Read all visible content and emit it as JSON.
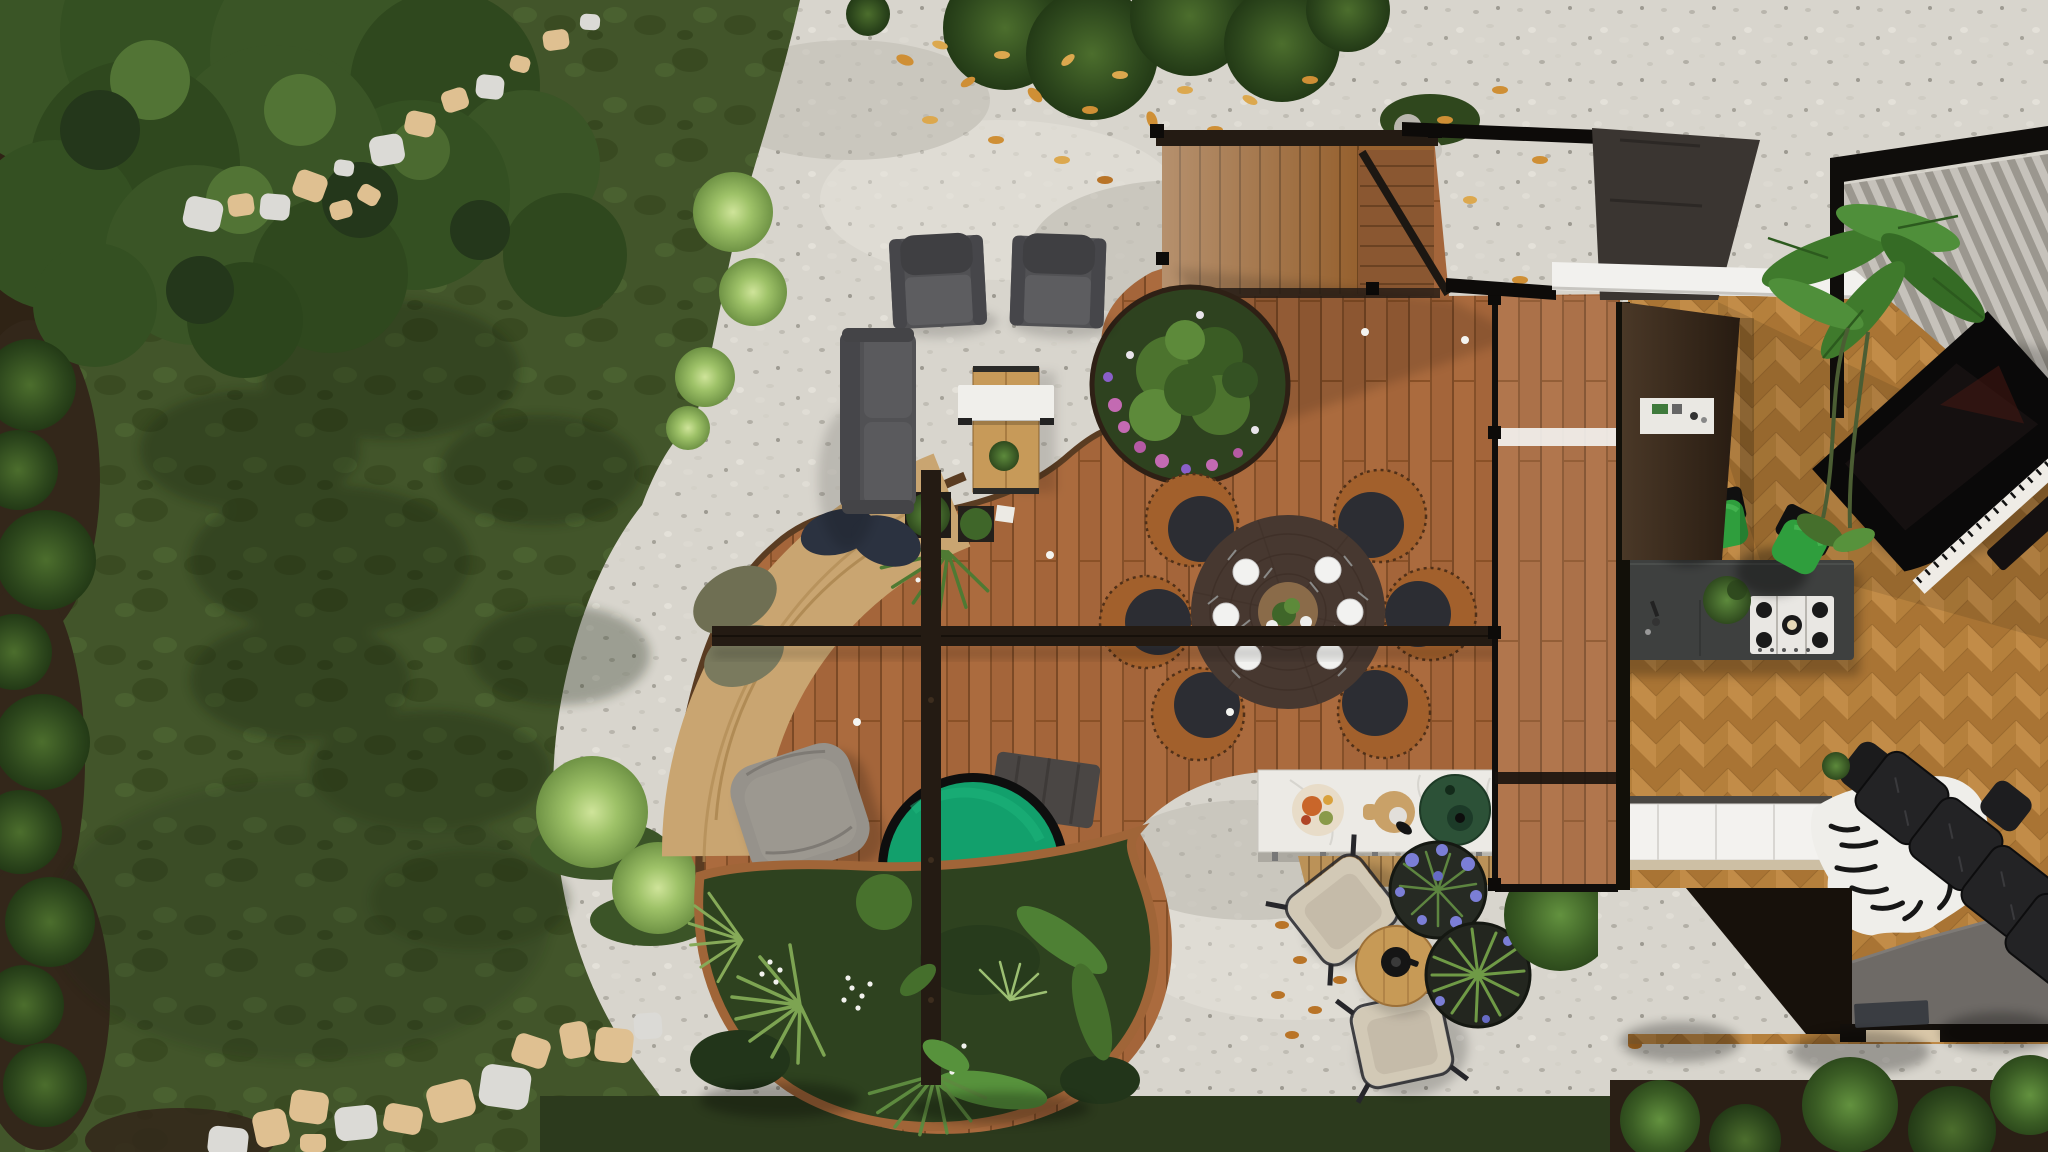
{
  "canvas": {
    "width": 2048,
    "height": 1152
  },
  "scene": {
    "type": "top-down landscape and interior design render",
    "areas": {
      "backyard_lawn": {
        "features": [
          "tree canopy",
          "upper stepping-stone path",
          "lower stepping-stone path",
          "shrub border",
          "ornamental grass puffs"
        ]
      },
      "gravel_patio": {
        "furniture": [
          "lounge armchair x2",
          "outdoor sofa",
          "wood table with white bench",
          "butterfly lounge chair x2",
          "round side table with kettle",
          "agapanthus planter pots"
        ]
      },
      "curved_deck": {
        "features": [
          "staircase",
          "round flower planter",
          "round dining table with six rattan chairs",
          "pergola beam and post",
          "green plunge tub",
          "gray ottoman",
          "floor cushions",
          "tiered curved bench",
          "tropical planting bed",
          "outdoor kitchen with kamado grill",
          "deck lights"
        ]
      },
      "house_interior": {
        "features": [
          "louvered roof",
          "white fascia",
          "herringbone parquet floor",
          "charcoal kitchen island with gas cooktop",
          "green bar stool x2",
          "white cabinet row",
          "grand piano",
          "banana plant",
          "zebra hide rug",
          "black leather seating",
          "entry mats",
          "wall shelf"
        ]
      }
    }
  },
  "palette": {
    "lawn_base": "#42552a",
    "lawn_bottom": "#2c3a1d",
    "soil": "#2f2315",
    "tree_mid": "#3a5526",
    "gravel_base": "#d8d5cd",
    "stone_tan": "#dfc091",
    "stone_gray": "#dbdad6",
    "leaf_orange": "#cf8f35",
    "deck_base": "#a8683c",
    "deck_light": "#c9a571",
    "deck_edge_dark": "#5a3c22",
    "deck_edge_terracotta": "#a06538",
    "stair_wood": "#96612f",
    "beam_dark": "#241b13",
    "foliage_base": "#2e421f",
    "flower_pink": "#c36ab2",
    "flower_purple": "#7b7ed6",
    "table_wood": "#473830",
    "rattan": "#a2602c",
    "chair_cushion": "#2c2d33",
    "plate_white": "#f2f2f0",
    "hot_tub_water": "#12a06c",
    "hot_tub_rim": "#0e0e0e",
    "pad_gray": "#4a4644",
    "pouf_gray": "#96928b",
    "cushion_navy": "#2b3240",
    "cushion_olive": "#6f6f53",
    "counter_marble": "#eceae5",
    "grill_green": "#2c5137",
    "cutting_board": "#c9a168",
    "sofa_gray": "#515154",
    "bench_white": "#f0efeb",
    "picnic_wood": "#c79a59",
    "canvas_beige": "#d2c9b6",
    "side_table_wood": "#c79a56",
    "pot_dark": "#262a23",
    "house_black": "#14100c",
    "roof_gray": "#3a3531",
    "wall_brown": "#3b2c1f",
    "fascia_white": "#f2f1ee",
    "louver_light": "#c6c2bb",
    "louver_dark": "#9b978f",
    "herring_a": "#c28c48",
    "herring_b": "#a97434",
    "island_charcoal": "#3e403f",
    "cooktop_white": "#e9e7e3",
    "stool_green": "#2f9e3d",
    "cabinet_white": "#f3f2ef",
    "entry_gray": "#6e6a66",
    "doormat_tan": "#d9c7a8",
    "mat_dark": "#3a3d42",
    "piano_black": "#0a0909",
    "piano_keys": "#efece6",
    "zebra_white": "#efeeea",
    "leather_black": "#232325"
  }
}
